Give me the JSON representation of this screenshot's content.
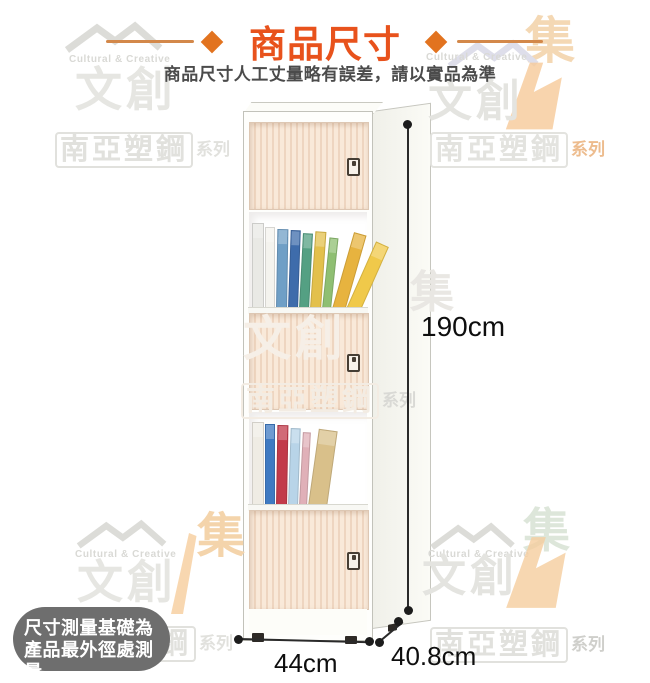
{
  "header": {
    "title": "商品尺寸",
    "subtitle": "商品尺寸人工丈量略有誤差，請以實品為準",
    "title_color": "#e8521c",
    "diamond_color": "#e2731f",
    "rule_color": "#d3884a"
  },
  "product": {
    "height_label": "190cm",
    "width_label": "44cm",
    "depth_label": "40.8cm"
  },
  "note_badge": {
    "line1": "尺寸測量基礎為",
    "line2": "產品最外徑處測量",
    "bg_color": "#6e6e6e",
    "text_color": "#ffffff"
  },
  "watermarks": {
    "brand_en": "Cultural & Creative",
    "brand_zh": "文創",
    "series_box": "南亞塑鋼",
    "series_suffix": "系列",
    "collect_char": "集"
  },
  "cabinet": {
    "door_base_color": "#f9e9d9",
    "door_stripe_color": "#eed5c0",
    "shelves": [
      {
        "books": [
          {
            "c": "#e9e9e5",
            "w": 10,
            "h": 84,
            "t": 0
          },
          {
            "c": "#f4f3ee",
            "w": 8,
            "h": 80,
            "t": 0
          },
          {
            "c": "#6f9fc6",
            "w": 9,
            "h": 78,
            "t": 1
          },
          {
            "c": "#3e6cab",
            "w": 8,
            "h": 77,
            "t": 2
          },
          {
            "c": "#54a083",
            "w": 8,
            "h": 74,
            "t": 3
          },
          {
            "c": "#e3c04c",
            "w": 9,
            "h": 76,
            "t": 4
          },
          {
            "c": "#8fbf72",
            "w": 7,
            "h": 70,
            "t": 6
          },
          {
            "c": "#e7b33f",
            "w": 11,
            "h": 78,
            "t": 16
          },
          {
            "c": "#f0c94a",
            "w": 12,
            "h": 72,
            "t": 24
          }
        ]
      },
      {
        "books": [
          {
            "c": "#efece4",
            "w": 10,
            "h": 82,
            "t": 0
          },
          {
            "c": "#3f7ac2",
            "w": 8,
            "h": 80,
            "t": 0
          },
          {
            "c": "#c23a4a",
            "w": 9,
            "h": 79,
            "t": 1
          },
          {
            "c": "#b8d4e8",
            "w": 8,
            "h": 76,
            "t": 2
          },
          {
            "c": "#e0b0b8",
            "w": 6,
            "h": 72,
            "t": 3
          },
          {
            "c": "#d9c08a",
            "w": 17,
            "h": 76,
            "t": 8
          }
        ]
      }
    ]
  }
}
